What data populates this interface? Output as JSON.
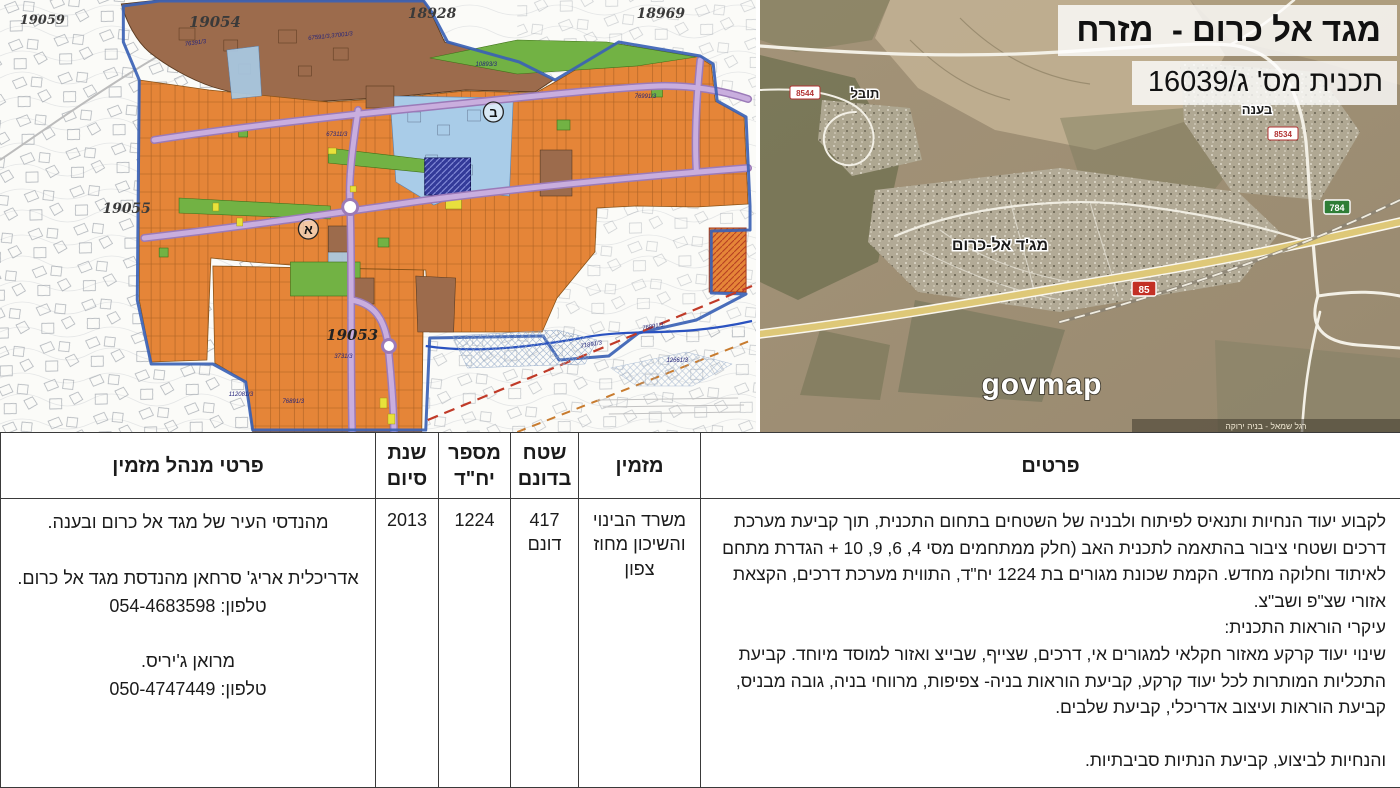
{
  "plan_title": {
    "line1": "מגד אל כרום -  מזרח",
    "line2": "תכנית מס' ג/16039"
  },
  "satellite": {
    "watermark": "govmap",
    "caption": "רגל שמאל - בניה ירוקה",
    "towns": {
      "tuval": "תובל",
      "baana": "בענה",
      "majd": "מג'ד אל-כרום"
    },
    "shields": {
      "s854": "8544",
      "s853": "8534",
      "s85": "85",
      "s784": "784"
    }
  },
  "zoning": {
    "blocks": {
      "b19059": "19059",
      "b19054": "19054",
      "b18928": "18928",
      "b18969": "18969",
      "b19055": "19055",
      "b19053": "19053"
    },
    "zones": {
      "alef": "א",
      "bet": "ב"
    },
    "parcels": [
      "76391/3",
      "67591/3,37001/3",
      "10893/3",
      "67311/3",
      "76991/3",
      "76891/3",
      "71891/3",
      "12661/3",
      "3731/3",
      "112081/3",
      "76891/3"
    ],
    "colors": {
      "residential_orange": "#e58538",
      "public_green": "#72b244",
      "road_purple": "#b692cc",
      "existing_brown": "#9c6b4c",
      "light_blue": "#a9cce8",
      "special_navy": "#333a99",
      "boundary_blue": "#3b62b5",
      "rail_red_dash": "#c03a28"
    }
  },
  "table": {
    "headers": {
      "details": "פרטים",
      "client": "מזמין",
      "area": "שטח בדונם",
      "units": "מספר יח\"ד",
      "year": "שנת סיום",
      "manager": "פרטי מנהל מזמין"
    },
    "row": {
      "details": "לקבוע יעוד הנחיות ותנאיס לפיתוח ולבניה של השטחים בתחום התכנית, תוך קביעת מערכת דרכים ושטחי ציבור בהתאמה לתכנית האב (חלק ממתחמים מסי 4, 6, 9, 10 + הגדרת מתחם לאיתוד וחלוקה מחדש. הקמת שכונת מגורים בת 1224 יח\"ד, התווית מערכת דרכים, הקצאת אזורי שצ\"פ ושב\"צ.\nעיקרי הוראות התכנית:\nשינוי יעוד קרקע מאזור חקלאי למגורים אי, דרכים, שצייף, שבייצ ואזור למוסד מיוחד. קביעת התכליות המותרות לכל יעוד קרקע, קביעת הוראות בניה- צפיפות, מרווחי בניה, גובה מבניס, קביעת הוראות ועיצוב אדריכלי, קביעת שלבים.\n\nוהנחיות לביצוע, קביעת הנתיות סביבתיות.",
      "client": "משרד הבינוי והשיכון מחוז צפון",
      "area": "417\nדונם",
      "units": "1224",
      "year": "2013",
      "manager": "מהנדסי העיר של מגד אל כרום ובענה.\n\nאדריכלית אריג' סרחאן מהנדסת מגד אל כרום.\nטלפון: 054-4683598\n\nמרואן ג'יריס.\nטלפון: 050-4747449"
    }
  }
}
